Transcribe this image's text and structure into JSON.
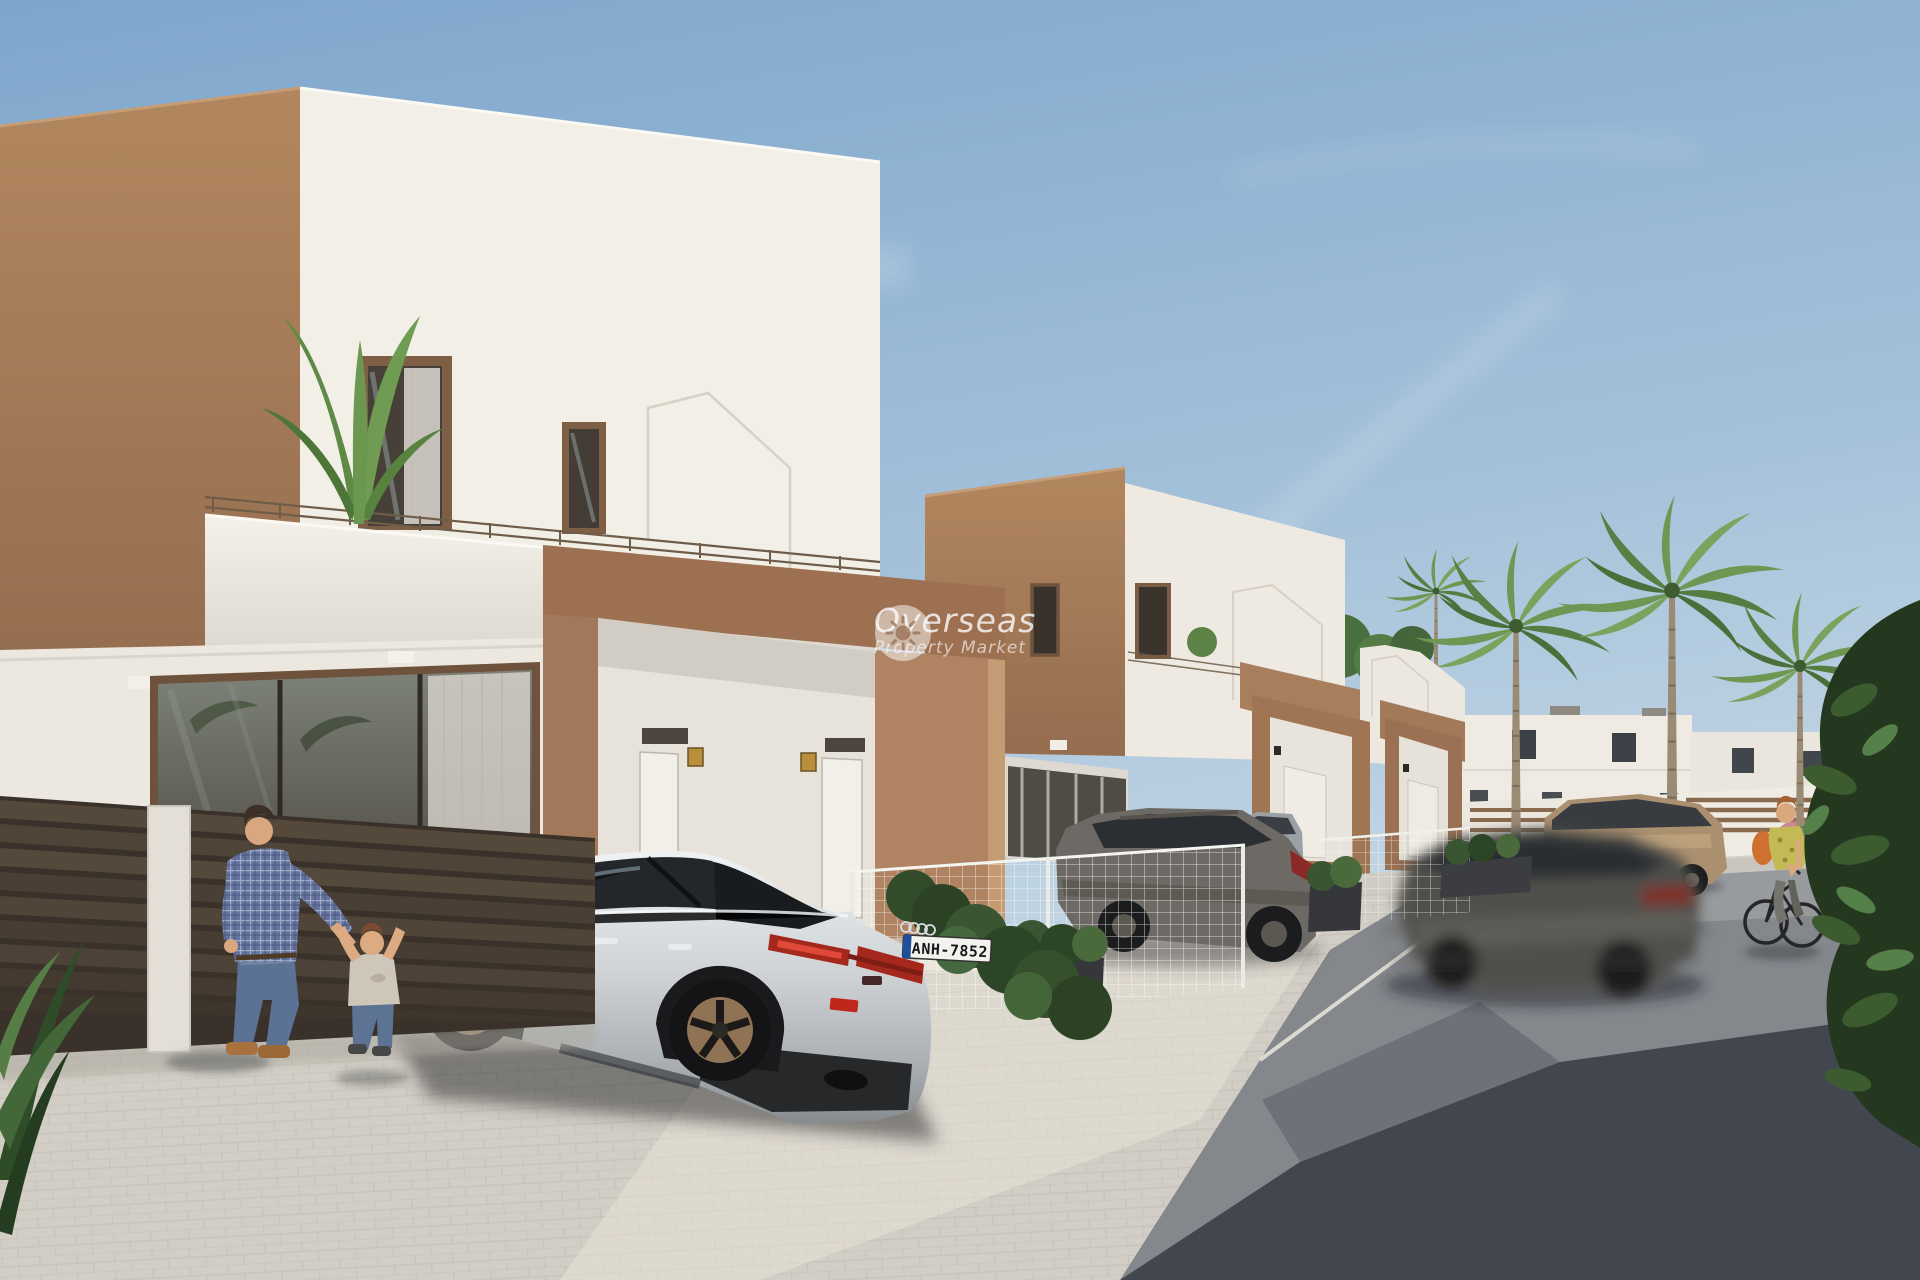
{
  "scene": {
    "type": "architectural render photograph",
    "description": "Sunny street of modern white and tan two-storey townhouses with roof terraces; parked cars on paver driveways, a man playing with a toddler by a dark slatted gate, a woman cycling past palm trees and white background villas",
    "sky": "clear blue with faint wispy clouds"
  },
  "watermark": {
    "brand": "Overseas",
    "tagline": "Property Market",
    "icon": "sun"
  },
  "vehicles": {
    "license_plate": "ANH-7852"
  },
  "palette": {
    "sky_top": "#82a9cd",
    "sky_horizon": "#cdddea",
    "wall_white_lit": "#f4f1e9",
    "wall_white_shade": "#e3dfd6",
    "wall_tan": "#a87e5e",
    "wall_tan_light": "#c2986f",
    "paver_light": "#d4d0c7",
    "road_gray": "#85888d",
    "road_shadow": "#3e434b",
    "fence_brown": "#4b4136",
    "foliage_dark": "#2c4424",
    "palm_green": "#6e9754",
    "car_silver": "#d9dbdd",
    "car_gray": "#6d6965",
    "car_bronze": "#ab9070",
    "taillight_red": "#b02a20",
    "plate_blue": "#1d4f9c"
  }
}
